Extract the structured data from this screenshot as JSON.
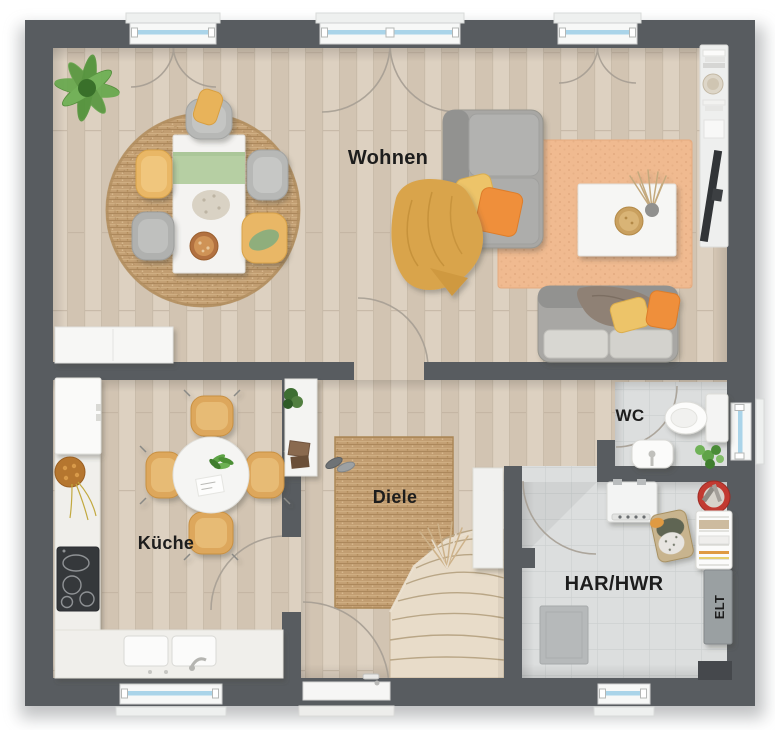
{
  "floorplan": {
    "rooms": {
      "wohnen": {
        "label": "Wohnen"
      },
      "kueche": {
        "label": "Küche"
      },
      "diele": {
        "label": "Diele"
      },
      "wc": {
        "label": "WC"
      },
      "har_hwr": {
        "label": "HAR/HWR"
      },
      "elt": {
        "label": "ELT"
      }
    },
    "colors": {
      "wall": "#585c60",
      "wood": "#d7cab9",
      "tile": "#dcdede",
      "tile_line": "#cbcfcf",
      "glass": "#aad4e9",
      "jute": "#c29e72",
      "living_rug": "#f0ba90",
      "sofa": "#a8a7a4",
      "accent_yellow": "#e7b05e",
      "accent_orange": "#ee8e3a",
      "green_runner": "#b6cfa3",
      "counter": "#f0efeb",
      "stair": "#e8dcc9",
      "arc": "#a69e93",
      "label": "#1d1d1d"
    }
  }
}
